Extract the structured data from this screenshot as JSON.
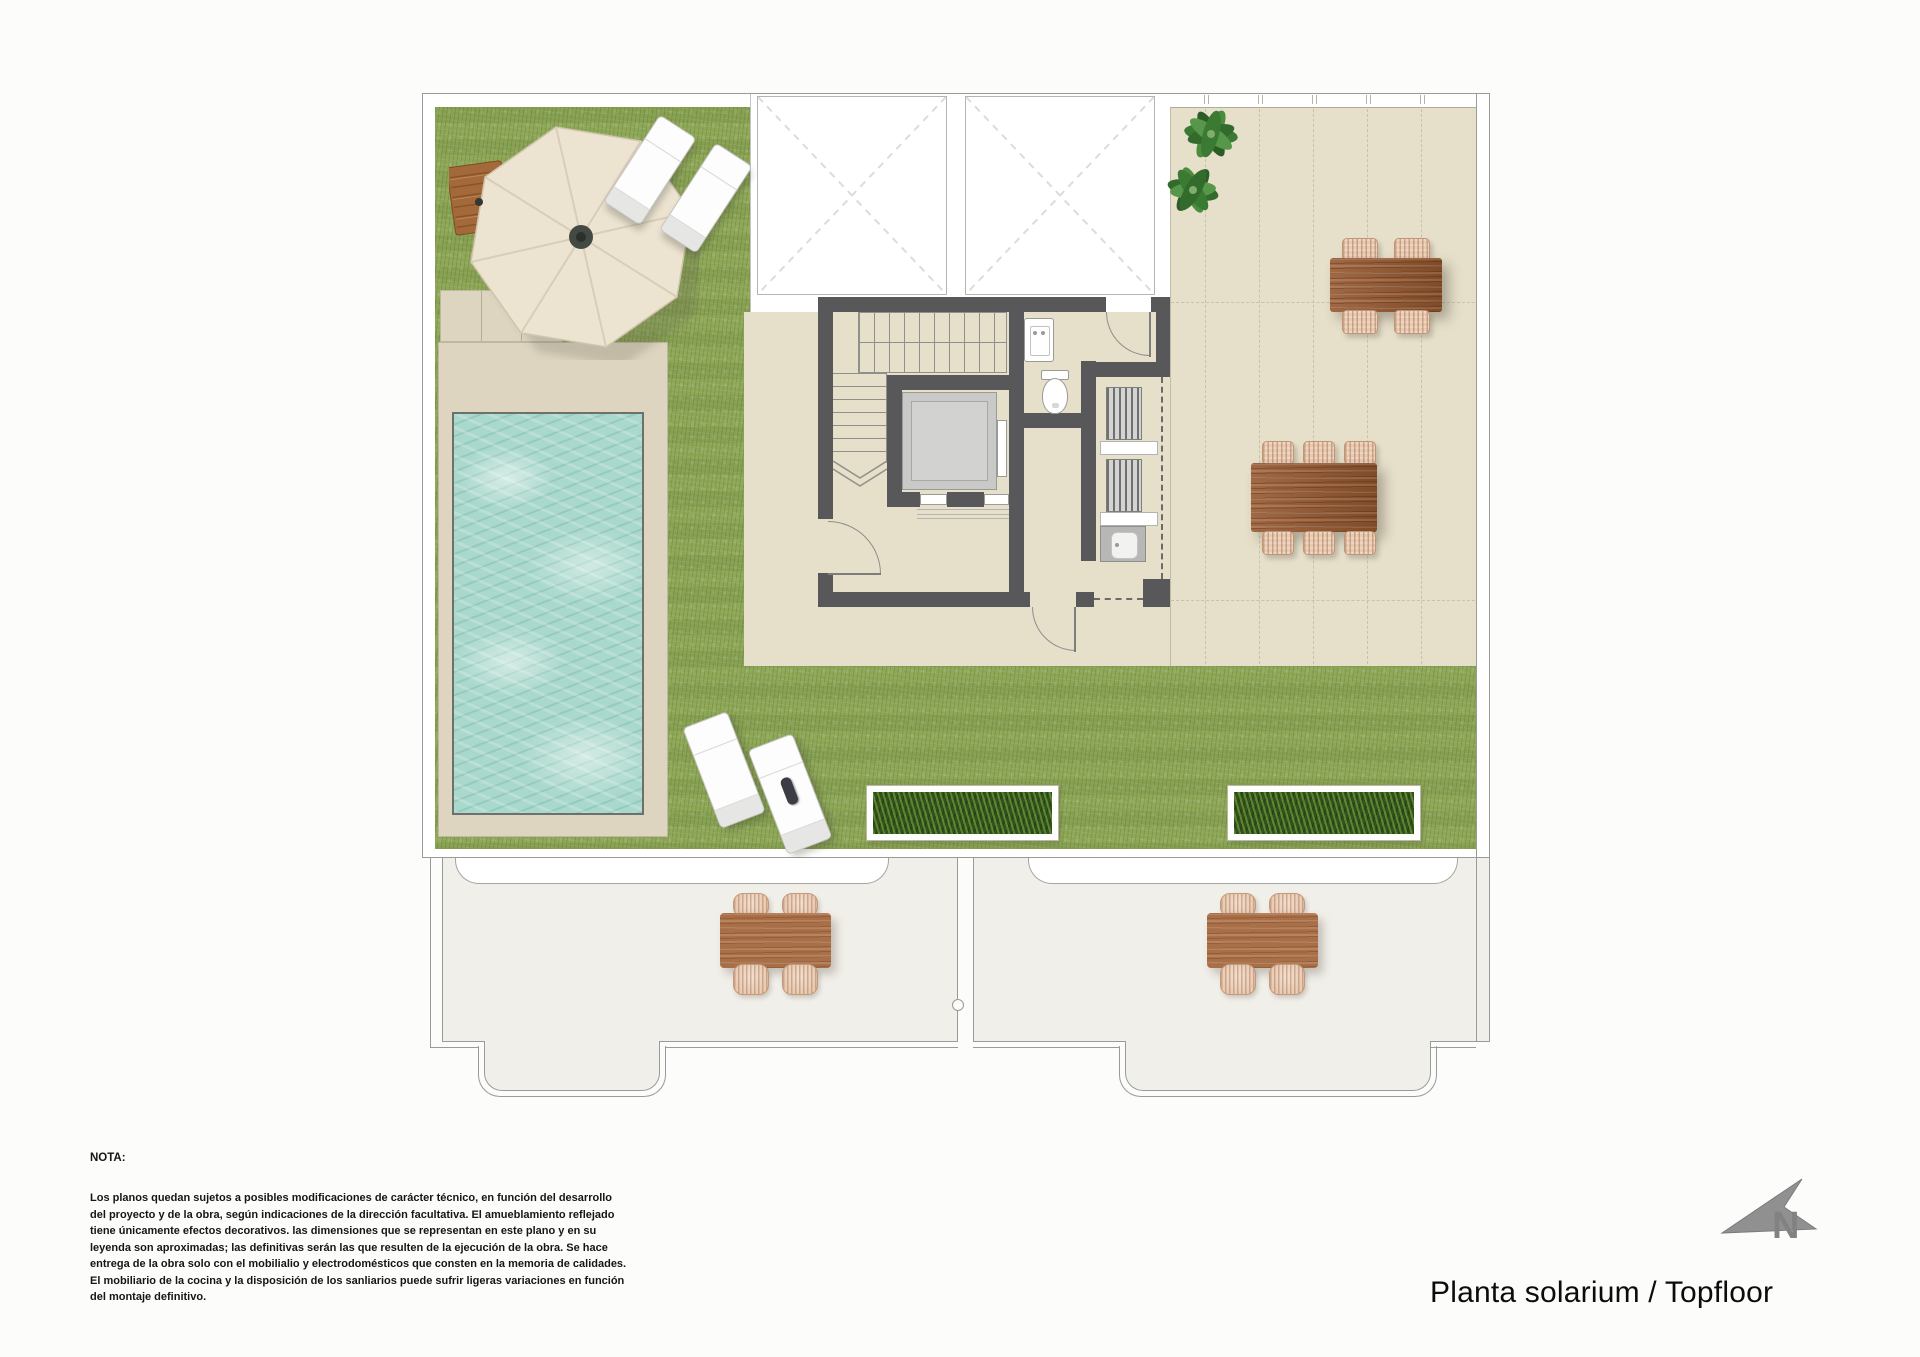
{
  "title": {
    "text": "Planta solarium / Topfloor"
  },
  "compass": {
    "label": "N"
  },
  "note": {
    "label": "NOTA:",
    "lines": [
      "Los planos quedan sujetos a posibles modificaciones de carácter técnico, en función del desarrollo",
      "del proyecto y de la obra, según indicaciones de la dirección facultativa. El amueblamiento reflejado",
      "tiene únicamente efectos decorativos. las dimensiones que se representan en este plano y en su",
      "leyenda son aproximadas; las definitivas serán las que resulten de la ejecución de la obra. Se hace",
      "entrega de la obra solo con el mobilialio y electrodomésticos que consten en la memoria de calidades.",
      "El mobiliario de la cocina y la disposición de los sanliarios puede sufrir ligeras variaciones en función",
      "del montaje definitivo."
    ]
  },
  "colors": {
    "grass": "#8ea757",
    "tile": "#e6dfca",
    "pool_deck": "#ddd5c0",
    "water": "#a9d8cc",
    "wall": "#58585a",
    "wood": "#96572e",
    "lower_terrace": "#f1efe9",
    "compass_gray": "#8f8f8f"
  }
}
